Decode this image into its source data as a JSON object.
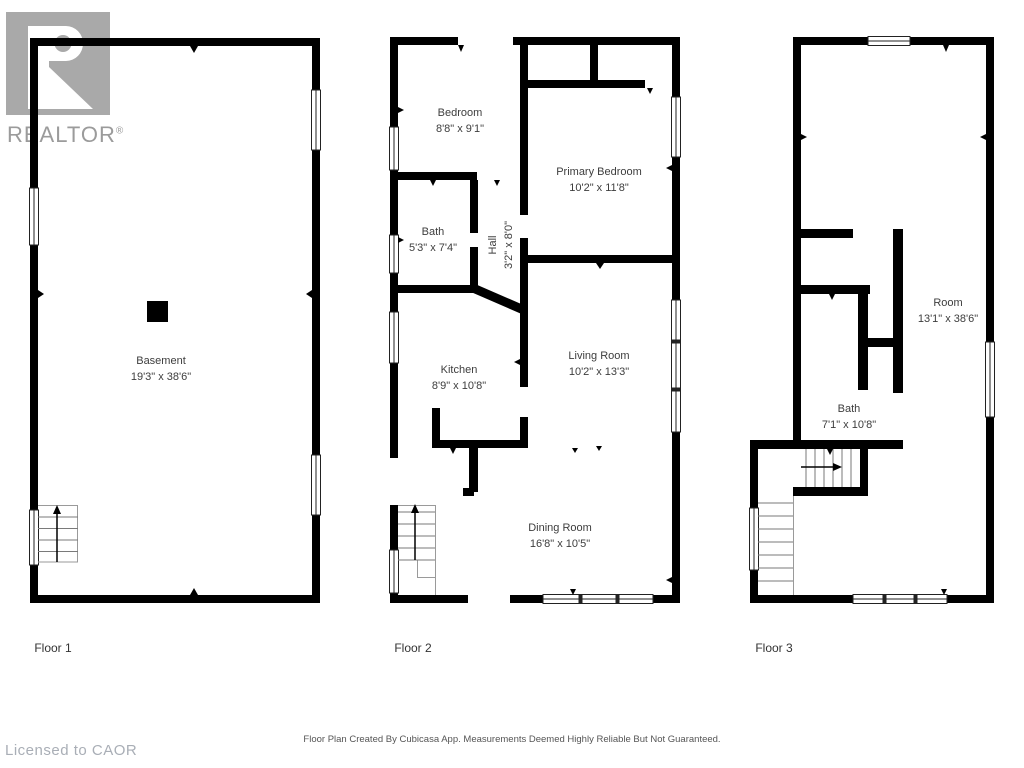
{
  "watermark": {
    "logo_text": "REALTOR",
    "registered": "®"
  },
  "floors": [
    {
      "label": "Floor 1",
      "rooms": [
        {
          "name": "Basement",
          "dims": "19'3\" x 38'6\""
        }
      ]
    },
    {
      "label": "Floor 2",
      "rooms": [
        {
          "name": "Bedroom",
          "dims": "8'8\" x 9'1\""
        },
        {
          "name": "Primary Bedroom",
          "dims": "10'2\" x 11'8\""
        },
        {
          "name": "Bath",
          "dims": "5'3\" x 7'4\""
        },
        {
          "name": "Hall",
          "dims": "3'2\" x 8'0\""
        },
        {
          "name": "Kitchen",
          "dims": "8'9\" x 10'8\""
        },
        {
          "name": "Living Room",
          "dims": "10'2\" x 13'3\""
        },
        {
          "name": "Dining Room",
          "dims": "16'8\" x 10'5\""
        }
      ]
    },
    {
      "label": "Floor 3",
      "rooms": [
        {
          "name": "Room",
          "dims": "13'1\" x 38'6\""
        },
        {
          "name": "Bath",
          "dims": "7'1\" x 10'8\""
        }
      ]
    }
  ],
  "footer": {
    "license": "Licensed to CAOR",
    "disclaimer": "Floor Plan Created By Cubicasa App. Measurements Deemed Highly Reliable But Not Guaranteed."
  },
  "colors": {
    "wall": "#000000",
    "room_label": "#3d3d3d",
    "logo_gray": "#a9a9a9",
    "logo_text_gray": "#9b9b9b",
    "license_gray": "#a9aeb6",
    "disclaimer_gray": "#555555"
  }
}
